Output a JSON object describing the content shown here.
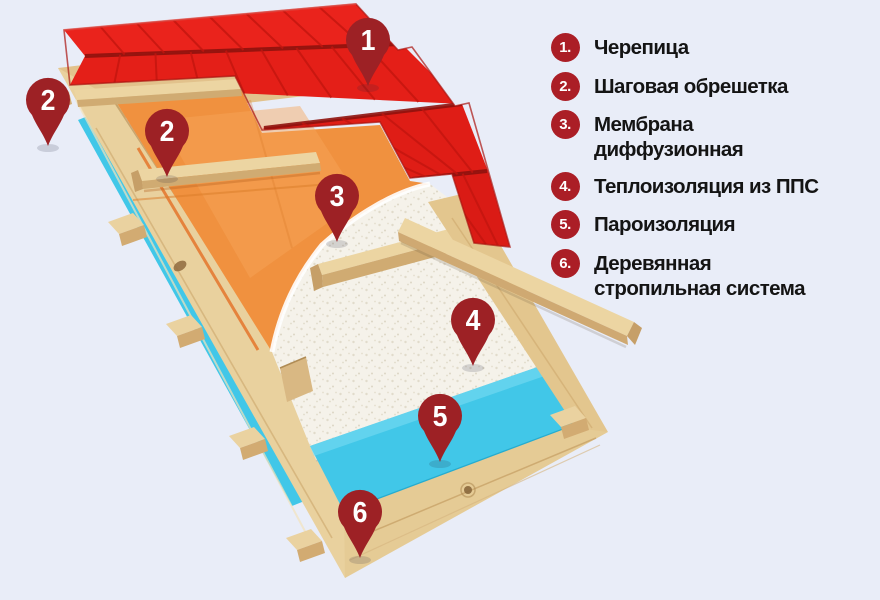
{
  "legend": {
    "items": [
      {
        "num": "1.",
        "label": "Черепица"
      },
      {
        "num": "2.",
        "label": "Шаговая обрешетка"
      },
      {
        "num": "3.",
        "label": "Мембрана диффузионная"
      },
      {
        "num": "4.",
        "label": "Теплоизоляция из ППС"
      },
      {
        "num": "5.",
        "label": "Пароизоляция"
      },
      {
        "num": "6.",
        "label": "Деревянная стропильная система"
      }
    ]
  },
  "diagram": {
    "pins": [
      {
        "num": "1"
      },
      {
        "num": "2"
      },
      {
        "num": "2"
      },
      {
        "num": "3"
      },
      {
        "num": "4"
      },
      {
        "num": "5"
      },
      {
        "num": "6"
      }
    ]
  },
  "colors": {
    "background": "#e9edf8",
    "roof_red": "#e41f18",
    "pin_red": "#9d2125",
    "legend_badge_red": "#ab1e26",
    "membrane_orange": "#f0913f",
    "vapor_barrier_cyan": "#41c7e8",
    "wood_tan": "#e9d19e",
    "foam_white": "#f5f2ea",
    "text_black": "#141414"
  }
}
